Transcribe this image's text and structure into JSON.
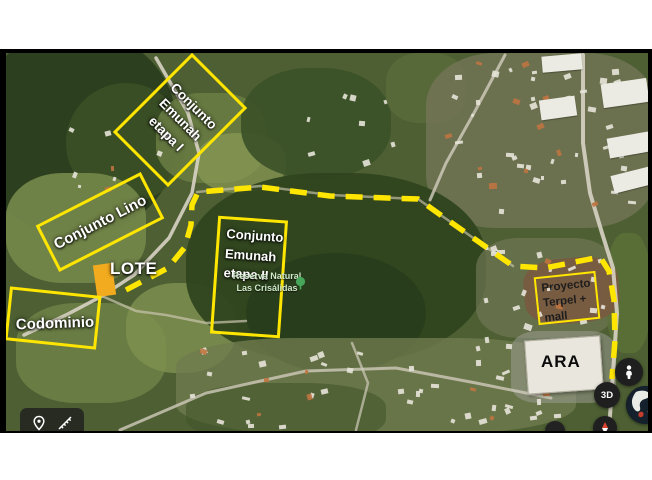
{
  "annotations": {
    "etapa1": {
      "lines": [
        "Conjunto",
        "Emunah",
        "etapa I"
      ]
    },
    "lino": {
      "label": "Conjunto Lino"
    },
    "lote": {
      "label": "LOTE"
    },
    "codominio": {
      "label": "Codominio"
    },
    "etapa2": {
      "lines": [
        "Conjunto",
        "Emunah",
        "etapa II"
      ]
    },
    "terpel": {
      "lines": [
        "Proyecto",
        "Terpel +",
        "mall"
      ]
    },
    "ara": {
      "label": "ARA"
    }
  },
  "map_labels": {
    "reserva": {
      "line1": "Reserva Natural",
      "line2": "Las Crisálidas",
      "icon": "tree-icon"
    }
  },
  "controls": {
    "threed_label": "3D",
    "toolbar_icons": [
      "location-pin-icon",
      "measure-ruler-icon"
    ],
    "buttons": [
      "street-view-pegman-button",
      "3d-toggle-button",
      "earth-globe-button",
      "compass-button"
    ]
  },
  "colors": {
    "annotation_yellow": "#ffe600",
    "route_yellow": "#ffe600",
    "lote_fill": "#f2ab1f",
    "label_white": "#ffffff",
    "terpel_text_dark": "#1d1d1d",
    "reserva_green": "#cfe9c9",
    "control_dark": "#1f1f1f"
  }
}
